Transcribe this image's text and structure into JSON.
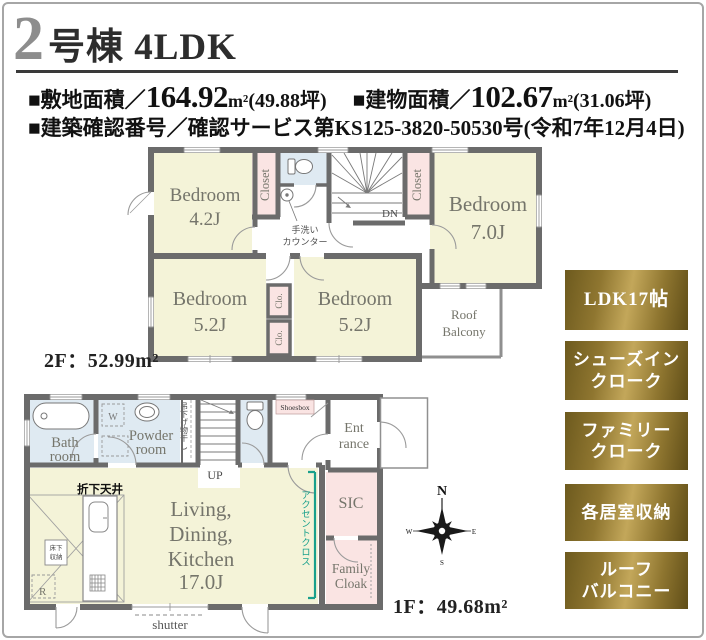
{
  "header": {
    "unit_number": "2",
    "unit_title": "号棟 4LDK",
    "land_label": "■敷地面積／",
    "land_value": "164.92",
    "land_unit": "m²",
    "land_tsubo": "(49.88坪)",
    "building_label": "■建物面積／",
    "building_value": "102.67",
    "building_unit": "m²",
    "building_tsubo": "(31.06坪)",
    "confirmation": "■建築確認番号／確認サービス第KS125-3820-50530号(令和7年12月4日)"
  },
  "floor2": {
    "area_label": "2F：52.99m²",
    "bedroom_42_name": "Bedroom",
    "bedroom_42_size": "4.2J",
    "bedroom_70_name": "Bedroom",
    "bedroom_70_size": "7.0J",
    "bedroom_52a_name": "Bedroom",
    "bedroom_52a_size": "5.2J",
    "bedroom_52b_name": "Bedroom",
    "bedroom_52b_size": "5.2J",
    "closet_left": "Closet",
    "closet_right": "Closet",
    "clo_upper": "Clo.",
    "clo_lower": "Clo.",
    "roof_balcony_line1": "Roof",
    "roof_balcony_line2": "Balcony",
    "stairs_down": "DN",
    "hand_wash_line1": "手洗い",
    "hand_wash_line2": "カウンター"
  },
  "floor1": {
    "area_label": "1F：49.68m²",
    "bath_line1": "Bath",
    "bath_line2": "room",
    "powder_line1": "Powder",
    "powder_line2": "room",
    "washer_mark": "W",
    "laundry_hanger": "吊下げ物干し",
    "stairs_up": "UP",
    "shoesbox": "Shoesbox",
    "entrance_line1": "Ent",
    "entrance_line2": "rance",
    "sic": "SIC",
    "family_cloak_line1": "Family",
    "family_cloak_line2": "Cloak",
    "ldk_line1": "Living,",
    "ldk_line2": "Dining,",
    "ldk_line3": "Kitchen",
    "ldk_line4": "17.0J",
    "dropped_ceiling": "折下天井",
    "floor_storage_line1": "床下",
    "floor_storage_line2": "収納",
    "refrigerator_mark": "R",
    "accent_cloth": "アクセントクロス",
    "shutter": "shutter"
  },
  "compass": {
    "north": "N",
    "east": "E",
    "south": "S",
    "west": "W"
  },
  "badges": [
    {
      "line1": "LDK17帖",
      "line2": ""
    },
    {
      "line1": "シューズイン",
      "line2": "クローク"
    },
    {
      "line1": "ファミリー",
      "line2": "クローク"
    },
    {
      "line1": "各居室収納",
      "line2": ""
    },
    {
      "line1": "ルーフ",
      "line2": "バルコニー"
    }
  ],
  "colors": {
    "room_yellow": "#f4f3d8",
    "room_blue": "#dfeaf2",
    "room_pink": "#fae4e3",
    "wall_gray": "#6b6b6b",
    "accent_teal": "#18a08c",
    "badge_gold_light": "#c3a75a",
    "badge_gold_dark": "#6d5a1e"
  }
}
